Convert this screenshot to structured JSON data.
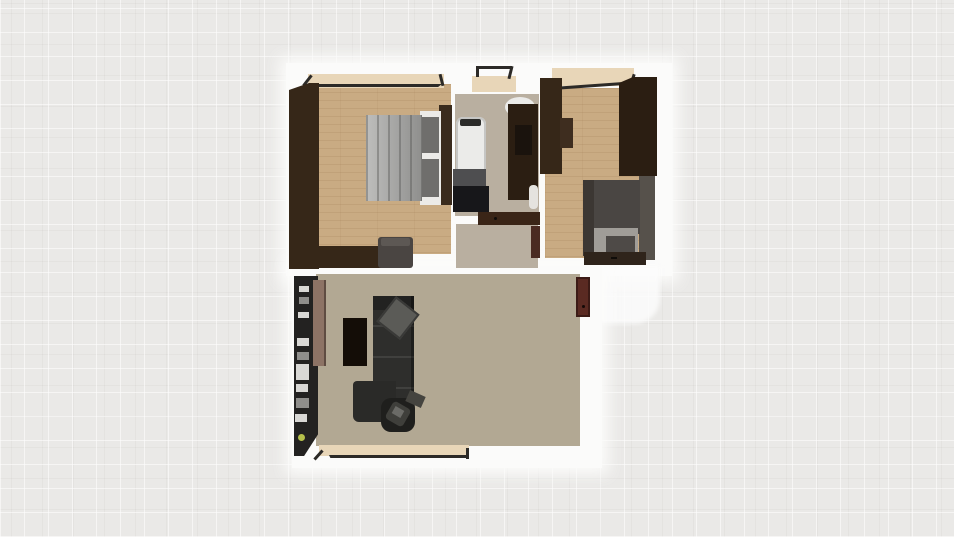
{
  "meta": {
    "scene_kind": "top-down 3D floor plan render",
    "visible_text": ""
  },
  "colors": {
    "bg": "#eae9e7",
    "wall_white": "#fbfbfa",
    "wood": "#c9ab83",
    "taupe_floor": "#b2a893",
    "beige_floor": "#b9afa0",
    "dark_wardrobe": "#362718",
    "dark_wardrobe2": "#2b1e12",
    "door_brown": "#8d7365",
    "door_red": "#5a2a22",
    "sofa_dark": "#2e2e2c",
    "sofa_cushion": "#5b5b57",
    "table_black": "#140d07",
    "bed_blanket": "#9b9b99",
    "mattress_white": "#ecebe8",
    "pillow_gray": "#6f6e6c",
    "bed2_dark": "#4a4643",
    "bed2_light": "#a09d98",
    "shelf_black": "#232221",
    "item_light": "#d9d8d5",
    "item_mid": "#8f8e8b",
    "plant_green": "#b5c04b",
    "tub_white": "#ebebe9",
    "tub_rim": "#c6c6c4",
    "vanity_gray": "#4e4e50",
    "vanity_black": "#17171a",
    "window_sill": "#e8d6b8",
    "window_frame": "#2c2a27",
    "rail_gray": "#56514b"
  },
  "scene": {
    "rooms": [
      {
        "id": "bedroom-left",
        "floor": "light-oak-wood"
      },
      {
        "id": "bathroom",
        "floor": "beige"
      },
      {
        "id": "hallway",
        "floor": "beige"
      },
      {
        "id": "bedroom-right",
        "floor": "light-oak-wood"
      },
      {
        "id": "living-room",
        "floor": "taupe"
      }
    ],
    "furniture": [
      {
        "id": "wardrobe-l-shaped",
        "room": "bedroom-left",
        "kind": "wardrobe"
      },
      {
        "id": "double-bed",
        "room": "bedroom-left",
        "kind": "bed"
      },
      {
        "id": "armchair",
        "room": "bedroom-left",
        "kind": "chair"
      },
      {
        "id": "bathtub",
        "room": "bathroom",
        "kind": "tub"
      },
      {
        "id": "vanity-washer",
        "room": "bathroom",
        "kind": "vanity"
      },
      {
        "id": "tall-cabinet",
        "room": "bathroom",
        "kind": "cabinet"
      },
      {
        "id": "toilet",
        "room": "bathroom",
        "kind": "toilet"
      },
      {
        "id": "wall-shelf",
        "room": "bedroom-right",
        "kind": "shelf"
      },
      {
        "id": "wardrobe-right",
        "room": "bedroom-right",
        "kind": "wardrobe"
      },
      {
        "id": "single-bed",
        "room": "bedroom-right",
        "kind": "bed"
      },
      {
        "id": "nightstand",
        "room": "bedroom-right",
        "kind": "dresser"
      },
      {
        "id": "media-shelf-unit",
        "room": "living-room",
        "kind": "shelving"
      },
      {
        "id": "open-door-leaf",
        "room": "living-room",
        "kind": "door"
      },
      {
        "id": "coffee-table",
        "room": "living-room",
        "kind": "table"
      },
      {
        "id": "sectional-sofa",
        "room": "living-room",
        "kind": "sofa"
      },
      {
        "id": "office-chair",
        "room": "living-room",
        "kind": "chair"
      },
      {
        "id": "side-object",
        "room": "living-room",
        "kind": "stool"
      },
      {
        "id": "potted-plant",
        "room": "living-room",
        "kind": "plant"
      },
      {
        "id": "entry-door",
        "room": "living-room",
        "kind": "door"
      }
    ],
    "windows": [
      "bedroom-left-top-window",
      "bathroom-top-window",
      "bedroom-right-top-window",
      "living-room-bottom-window"
    ]
  }
}
